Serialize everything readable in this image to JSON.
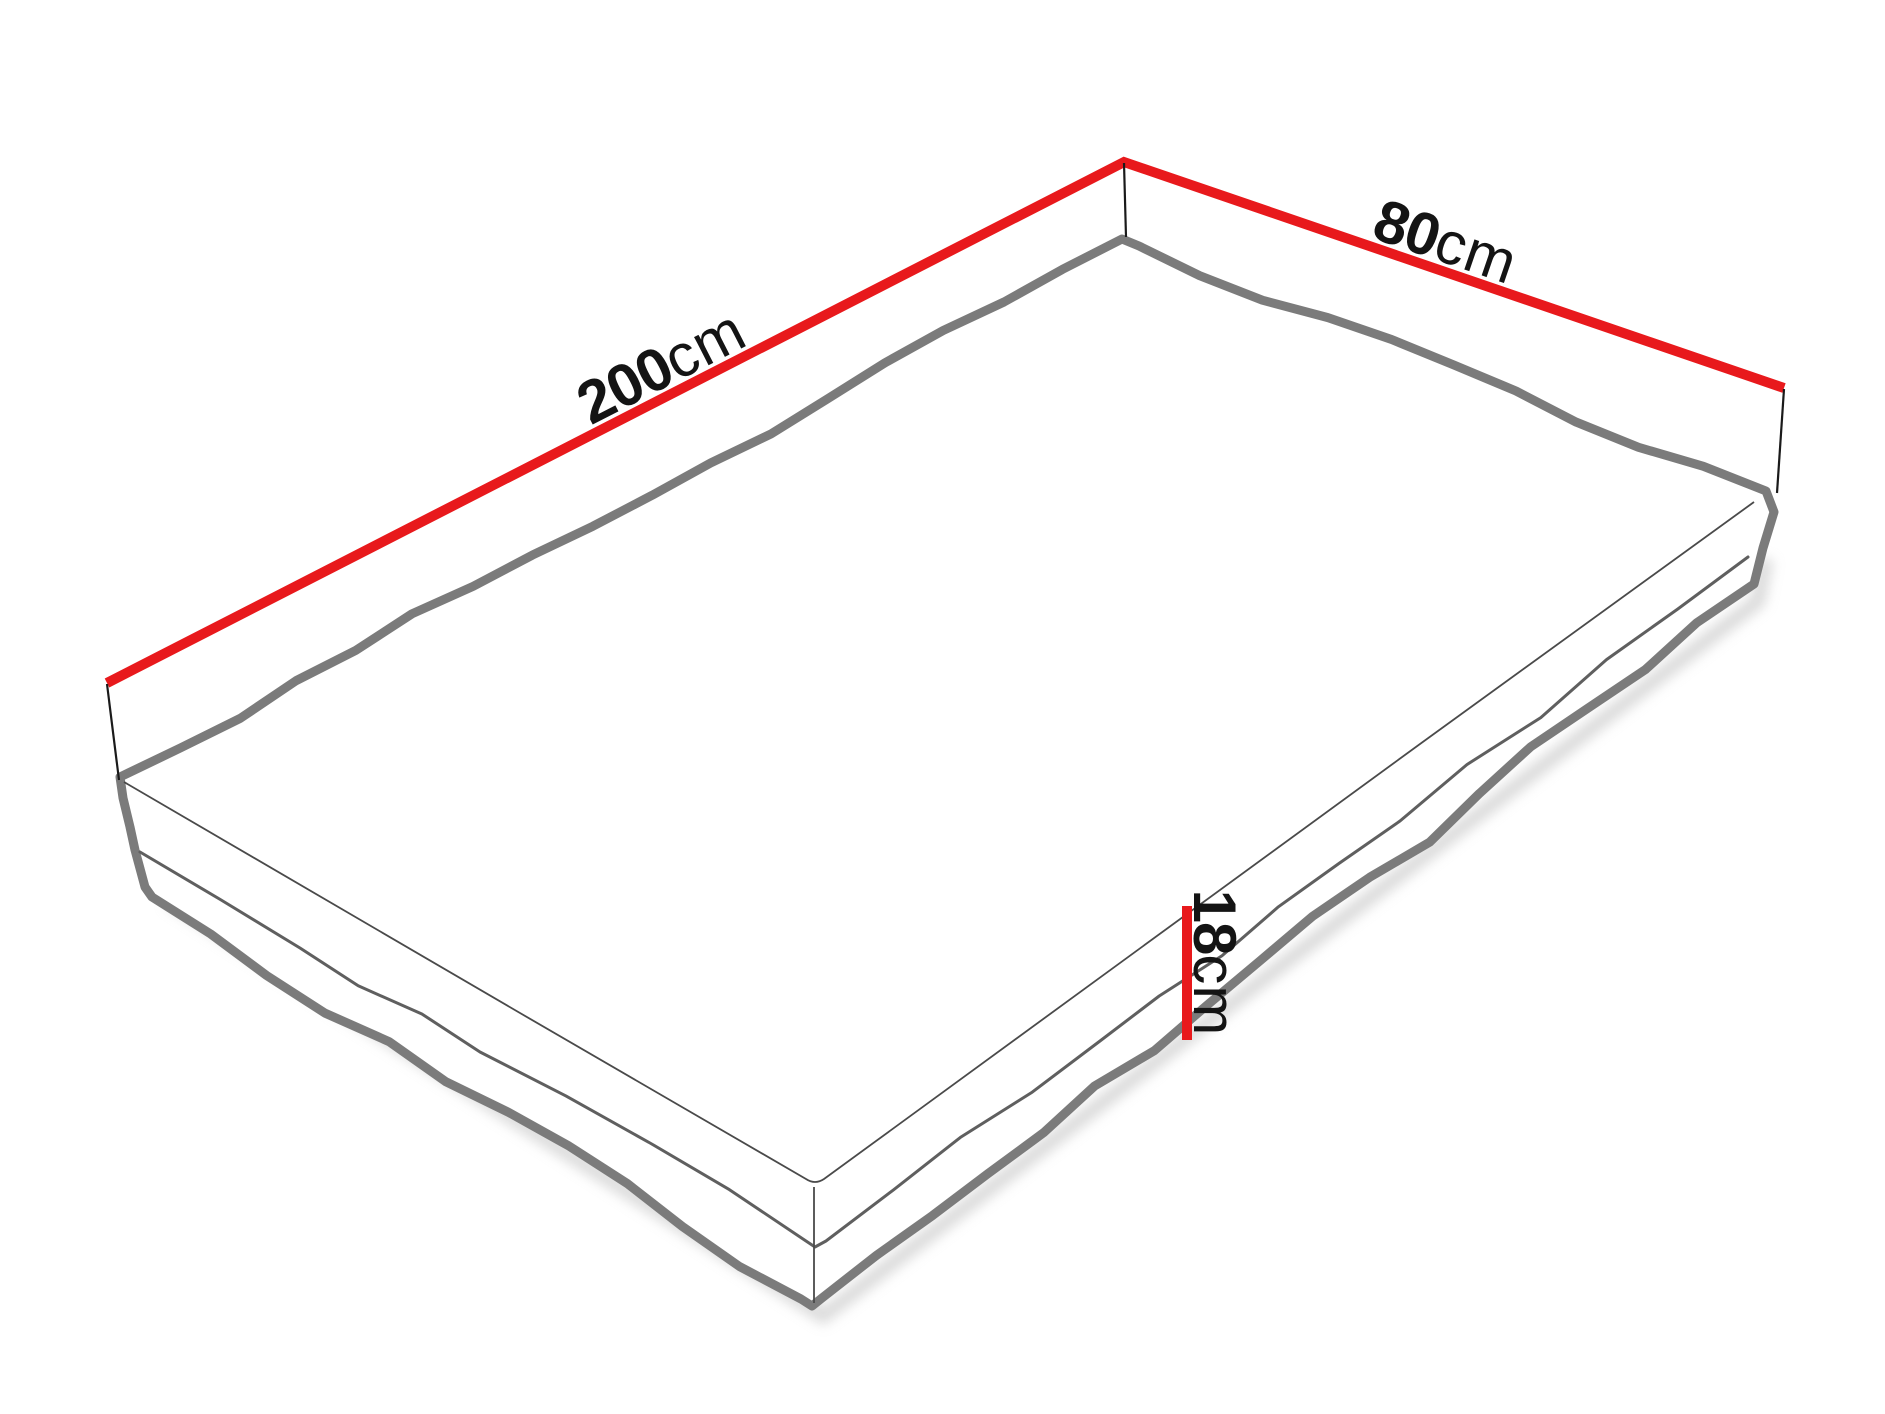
{
  "diagram": {
    "name": "Mattress dimensions diagram",
    "labels": {
      "length": {
        "value": "200",
        "unit": "cm"
      },
      "width": {
        "value": "80",
        "unit": "cm"
      },
      "height": {
        "value": "18",
        "unit": "cm"
      }
    },
    "colors": {
      "background": "#ffffff",
      "dimension_line": "#e8191c",
      "tick": "#1a1a1a",
      "outline": "#7b7b7b",
      "top_seam": "#4a4a4a",
      "middle_seam": "#5f5f5f",
      "corner_edge": "#4a4a4a",
      "shadow": "#b8b8b8",
      "text": "#141414"
    }
  }
}
